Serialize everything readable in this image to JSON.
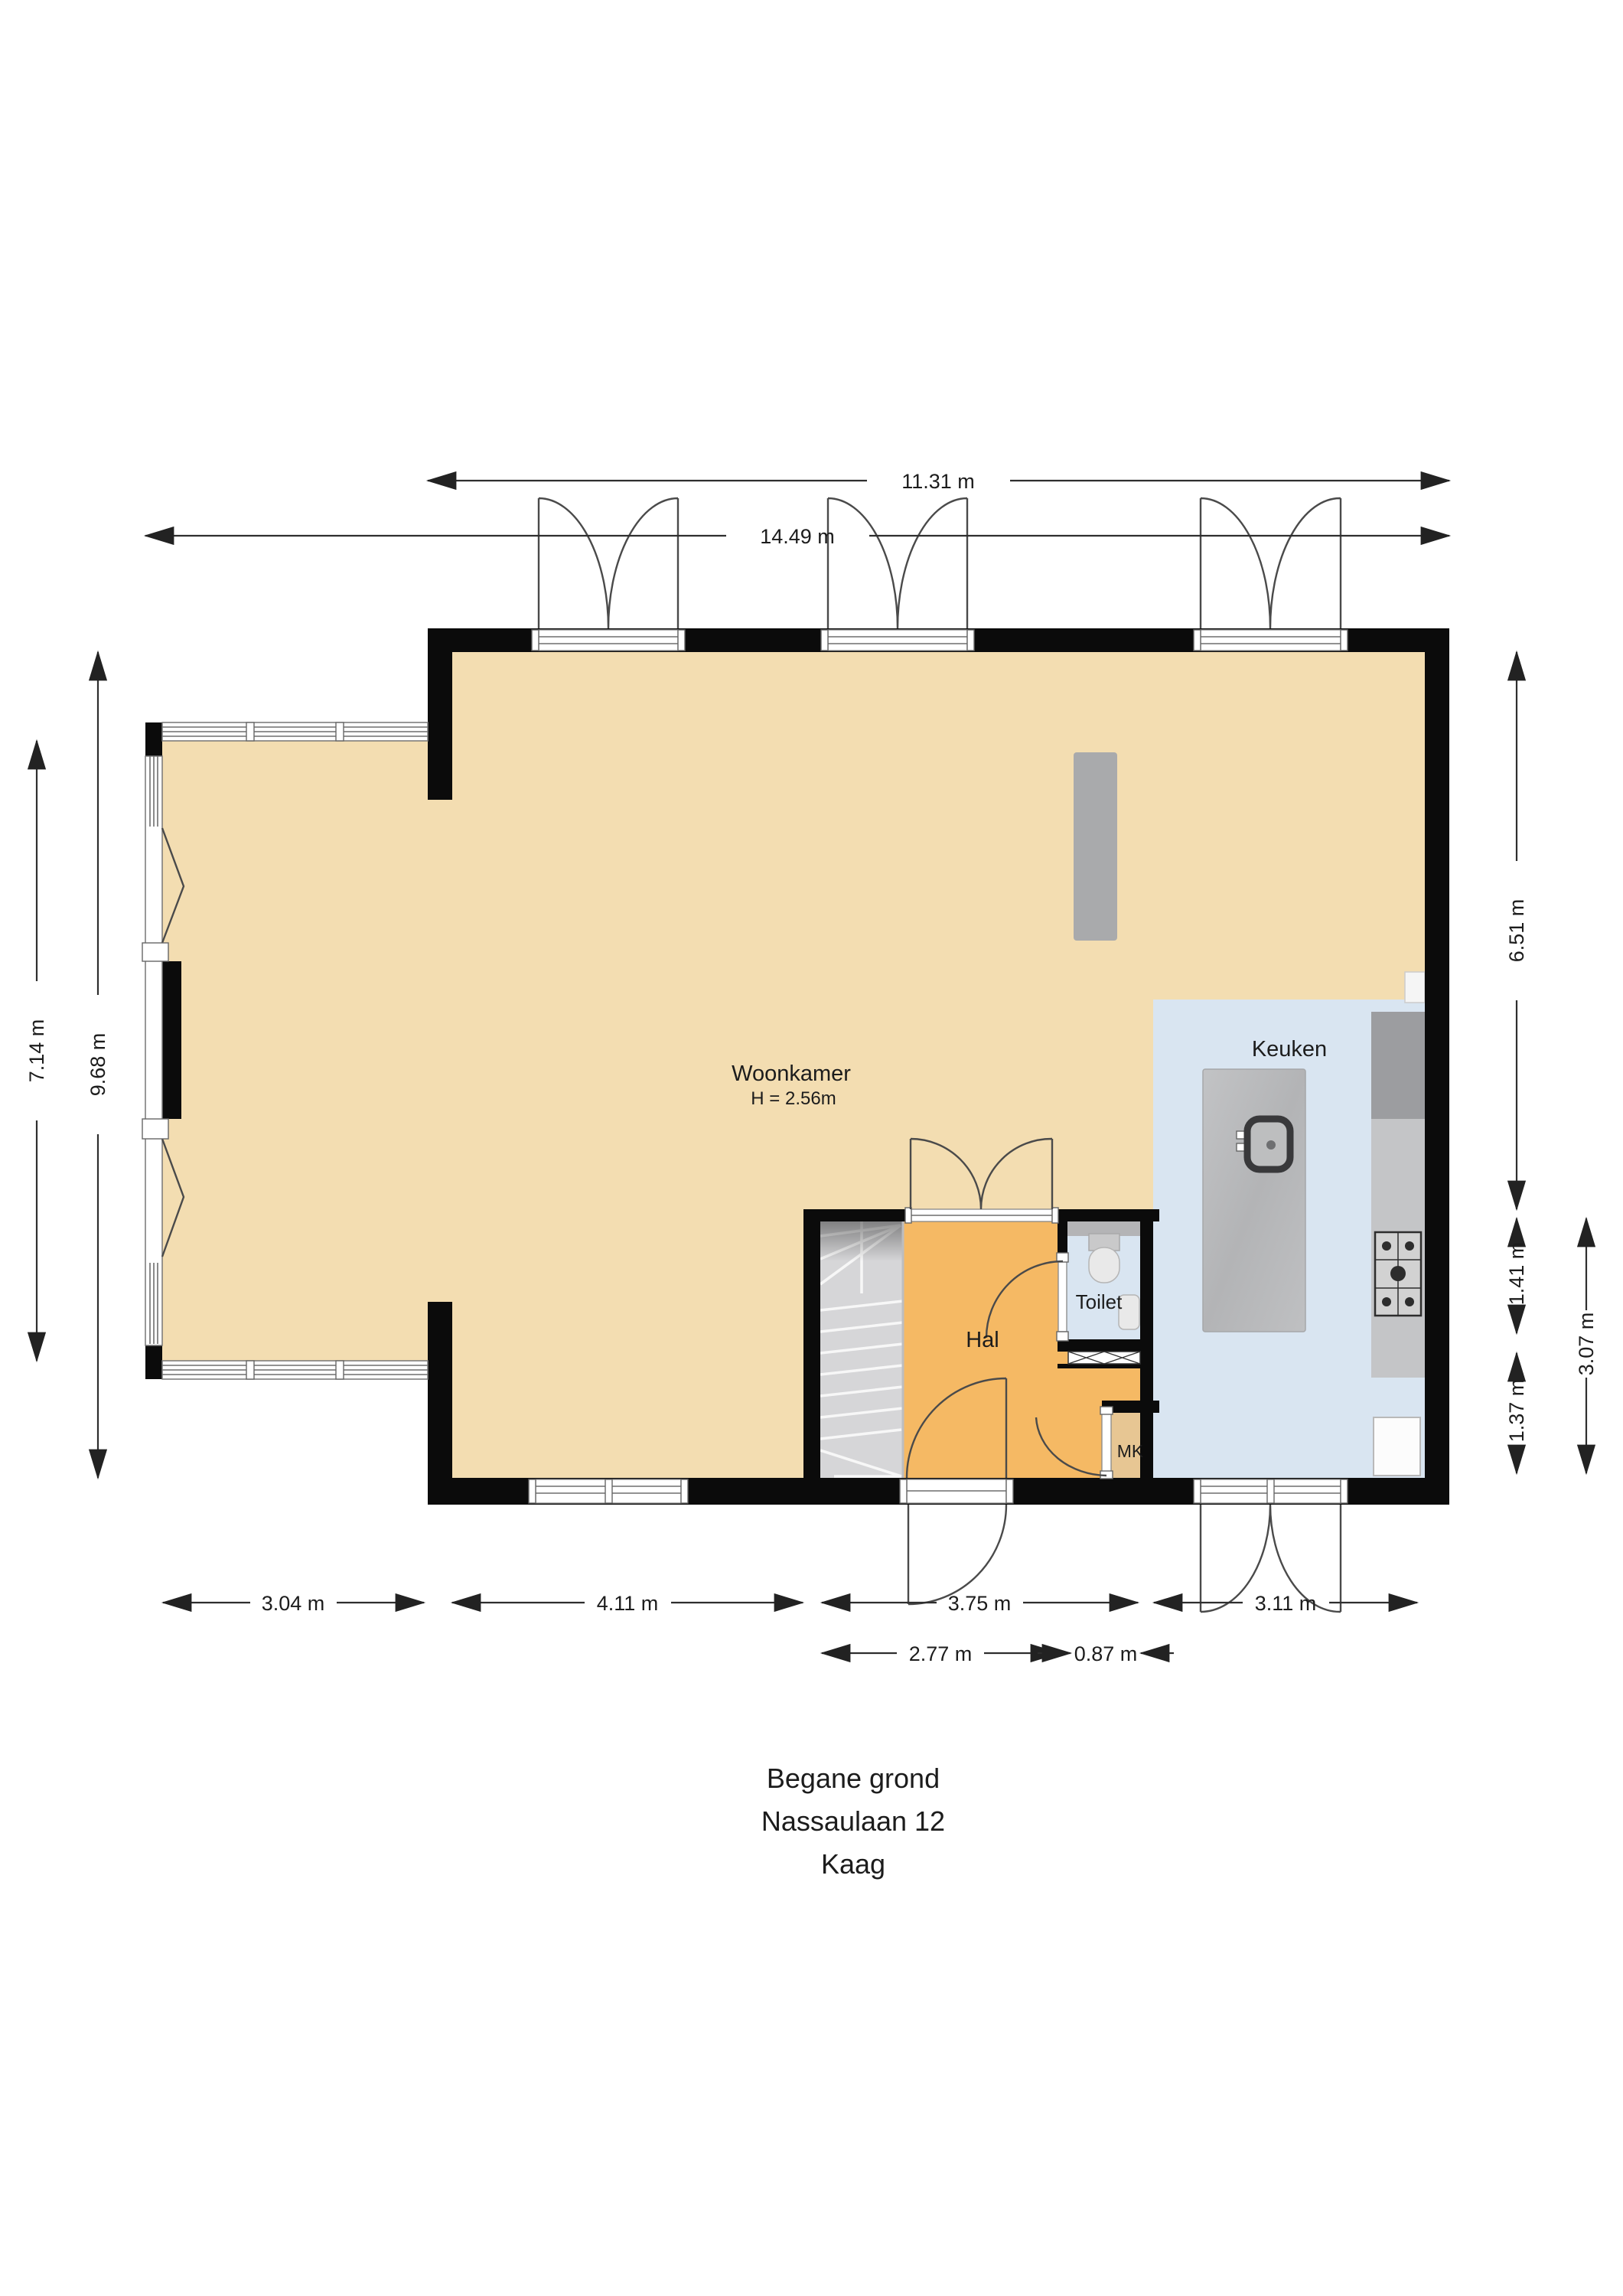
{
  "title": {
    "line1": "Begane grond",
    "line2": "Nassaulaan 12",
    "line3": "Kaag"
  },
  "rooms": {
    "living": {
      "label": "Woonkamer",
      "height_note": "H = 2.56m"
    },
    "kitchen": {
      "label": "Keuken"
    },
    "toilet": {
      "label": "Toilet"
    },
    "hall": {
      "label": "Hal"
    },
    "meter_closet": {
      "label": "MK"
    }
  },
  "dimensions": {
    "top_main": "11.31 m",
    "top_total": "14.49 m",
    "left_wing": "7.14 m",
    "left_total": "9.68 m",
    "right_upper": "6.51 m",
    "right_middle": "1.41 m",
    "right_lower": "1.37 m",
    "right_lower_total": "3.07 m",
    "bottom_wing": "3.04 m",
    "bottom_living": "4.11 m",
    "bottom_hall": "3.75 m",
    "bottom_kitchen": "3.11 m",
    "bottom_hall_inner": "2.77 m",
    "bottom_mk": "0.87 m"
  },
  "icons": {
    "sink": "kitchen-sink-icon",
    "hob": "gas-hob-icon",
    "wc": "toilet-icon",
    "basin": "hand-basin-icon",
    "stairs": "winder-staircase-icon",
    "grille": "vent-grille-icon"
  },
  "colors": {
    "floor_living": "#f3ddb1",
    "floor_hall": "#f5b964",
    "floor_kitchen": "#d9e5f1",
    "floor_mk": "#e7c693",
    "wall": "#0b0b0b",
    "stairs": "#d6d6d8",
    "island": "#b9babc",
    "counter": "#c4c5c7",
    "cabinet": "#9c9da0",
    "ledge": "#b4b4b6",
    "gray_bar": "#a9aaac",
    "dim_line": "#2e2e2e"
  }
}
